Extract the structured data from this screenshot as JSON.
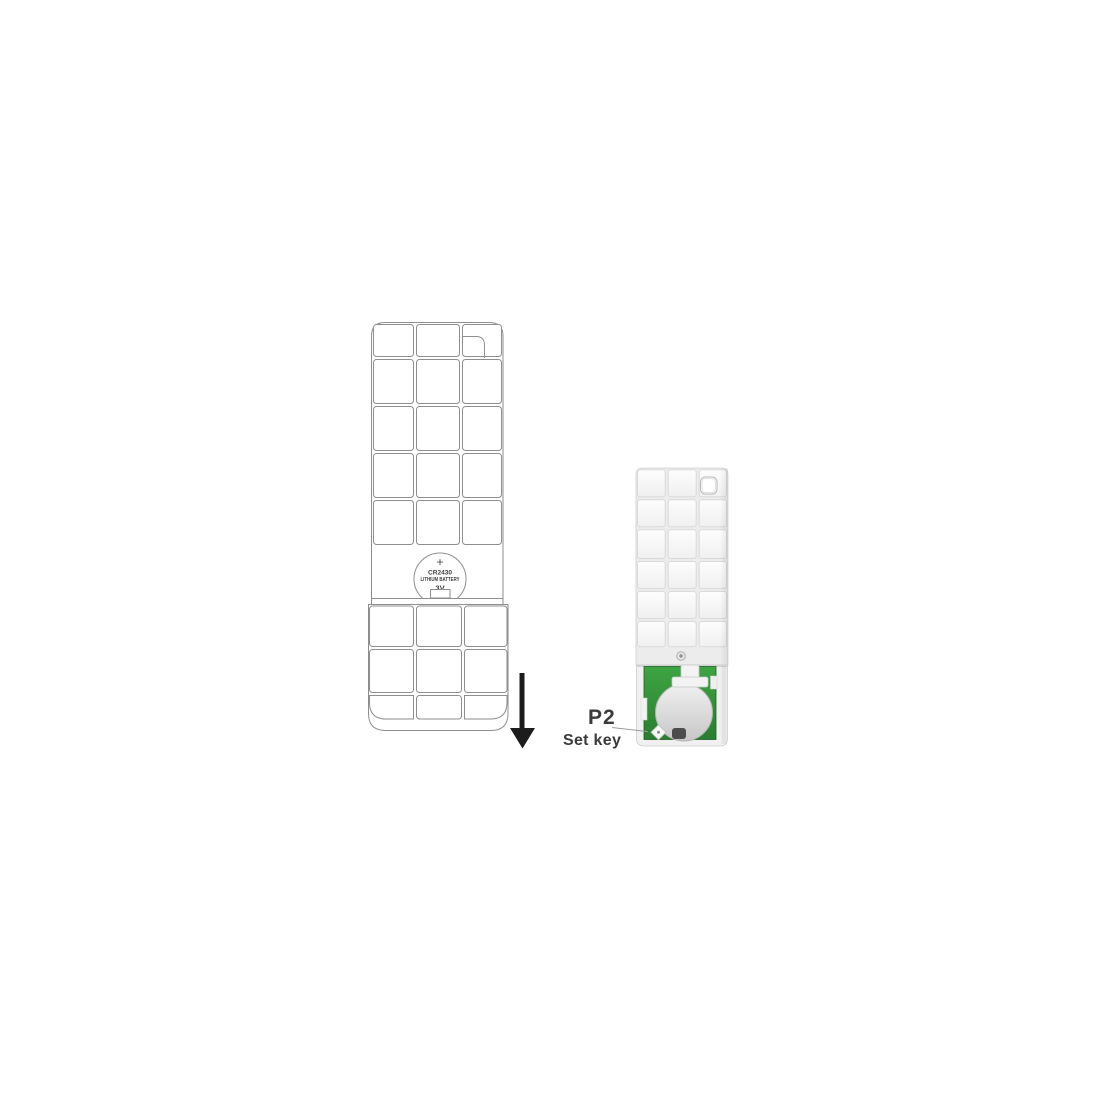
{
  "figure": {
    "left_outline": {
      "battery": {
        "polarity": "+",
        "model": "CR2430",
        "type": "LITHIUM BATTERY",
        "voltage": "3V"
      }
    },
    "callout": {
      "button_id": "P2",
      "button_name": "Set key"
    },
    "colors": {
      "outline_gray": "#8e8e8e",
      "arrow_black": "#1c1c1c",
      "pcb_green": "#2f9034",
      "battery_silver": "#d9d9d9",
      "label_text": "#3b3b3b",
      "leader_line": "#9c9c9c"
    }
  }
}
